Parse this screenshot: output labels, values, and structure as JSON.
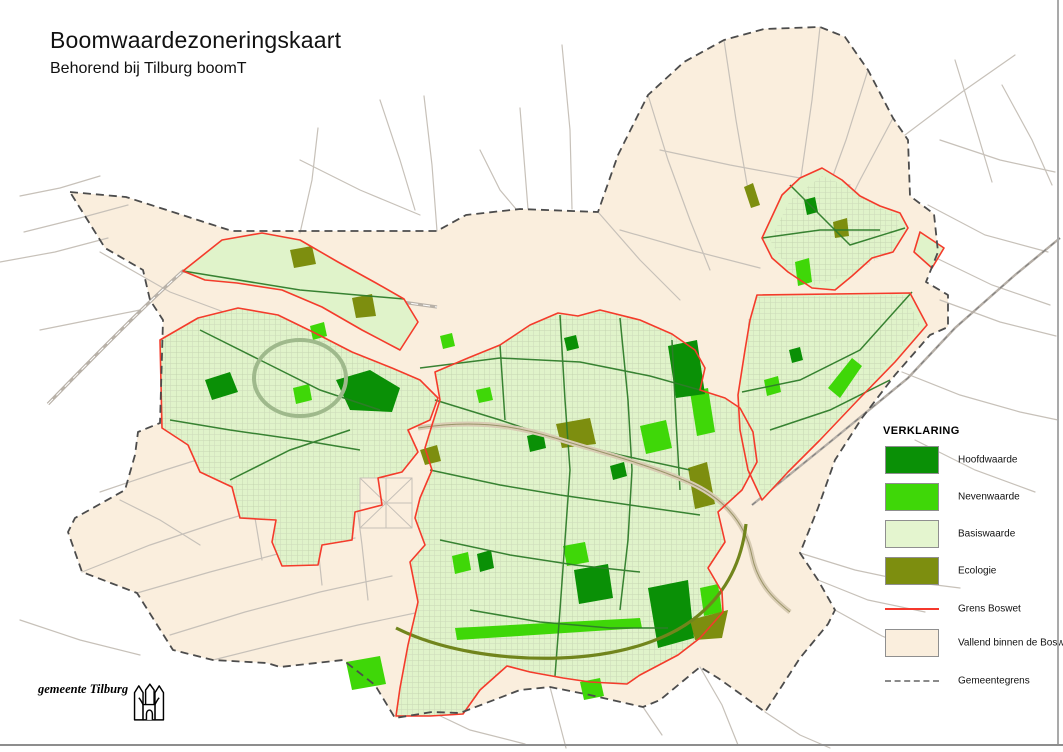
{
  "header": {
    "title": "Boomwaardezoneringskaart",
    "subtitle": "Behorend bij Tilburg boomT"
  },
  "legend": {
    "heading": "VERKLARING",
    "items": [
      {
        "label": "Hoofdwaarde",
        "type": "swatch",
        "color": "#0a9006"
      },
      {
        "label": "Nevenwaarde",
        "type": "swatch",
        "color": "#3fd708"
      },
      {
        "label": "Basiswaarde",
        "type": "swatch",
        "color": "#e4f5cf"
      },
      {
        "label": "Ecologie",
        "type": "swatch",
        "color": "#7d8e0f"
      },
      {
        "label": "Grens Boswet",
        "type": "line",
        "color": "#f5382c"
      },
      {
        "label": "Vallend binnen de Boswet",
        "type": "swatch",
        "color": "#faeedd"
      },
      {
        "label": "Gemeentegrens",
        "type": "dashed",
        "color": "#8a8a8a"
      }
    ]
  },
  "attribution": {
    "text": "gemeente Tilburg"
  },
  "map_palette": {
    "outside": "#ffffff",
    "municipality_fill": "#faeedd",
    "municipality_border": "#4c4c4c",
    "zone_fill": "#e0f3ca",
    "zone_border": "#f43b2b",
    "hoofdwaarde": "#0a9006",
    "nevenwaarde": "#3fd708",
    "ecologie": "#7d8e0f",
    "roads": "#c7c1b9",
    "city_streets": "#2f7d2a"
  }
}
